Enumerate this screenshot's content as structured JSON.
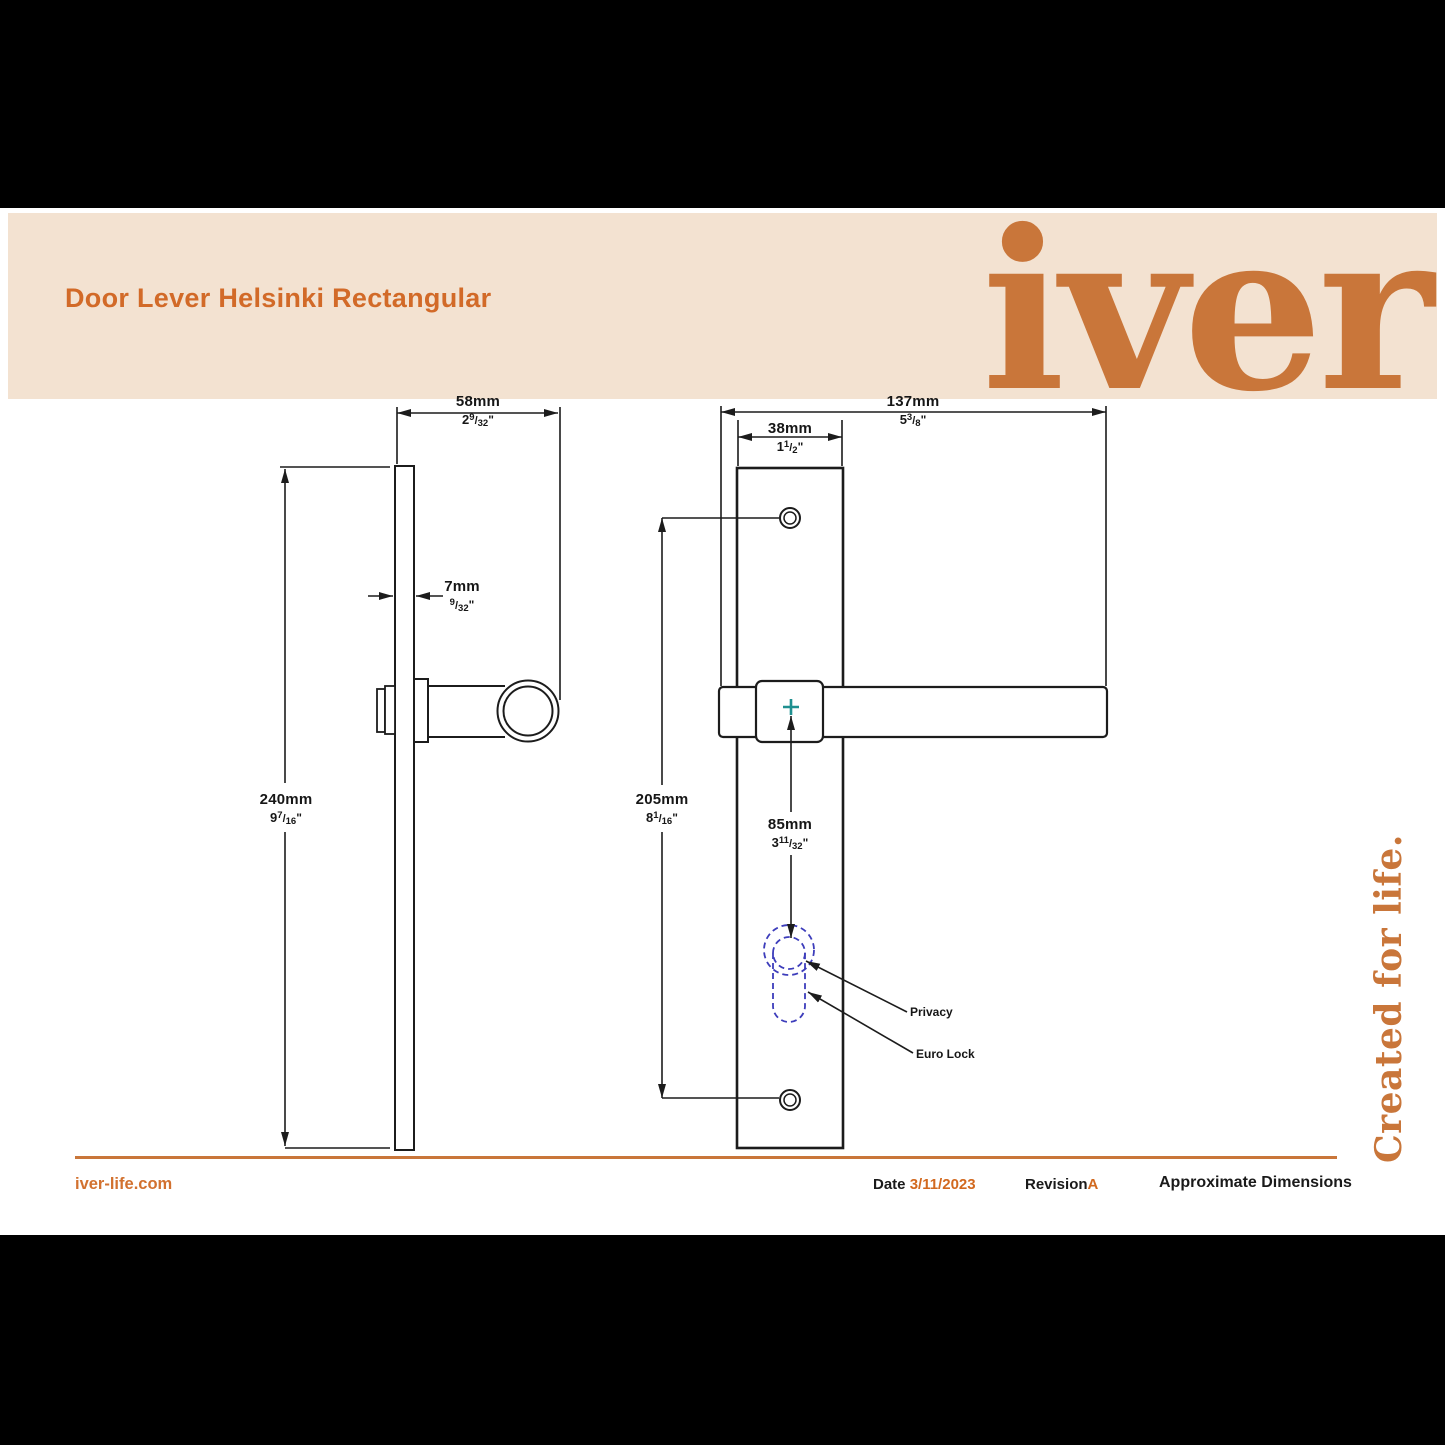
{
  "header": {
    "title": "Door Lever Helsinki Rectangular",
    "logo": "iver"
  },
  "side_text": "Created for life.",
  "footer": {
    "website": "iver-life.com",
    "date_label": "Date",
    "date_value": "3/11/2023",
    "revision_label": "Revision",
    "revision_value": "A",
    "note": "Approximate Dimensions"
  },
  "drawing": {
    "annotations": {
      "privacy": "Privacy",
      "euro_lock": "Euro Lock"
    },
    "dimensions": {
      "side_width": {
        "mm": "58mm",
        "whole": "2",
        "num": "9",
        "den": "32"
      },
      "plate_thickness": {
        "mm": "7mm",
        "whole": "",
        "num": "9",
        "den": "32"
      },
      "side_height": {
        "mm": "240mm",
        "whole": "9",
        "num": "7",
        "den": "16"
      },
      "front_width": {
        "mm": "137mm",
        "whole": "5",
        "num": "3",
        "den": "8"
      },
      "plate_width": {
        "mm": "38mm",
        "whole": "1",
        "num": "1",
        "den": "2"
      },
      "hole_span": {
        "mm": "205mm",
        "whole": "8",
        "num": "1",
        "den": "16"
      },
      "lever_to_lock": {
        "mm": "85mm",
        "whole": "3",
        "num": "11",
        "den": "32"
      }
    }
  },
  "colors": {
    "band_peach": "#f3e2d1",
    "brand_orange": "#c9763a",
    "accent_orange": "#d26a28",
    "lock_blue": "#3d3dbb",
    "center_teal": "#1f9090"
  }
}
